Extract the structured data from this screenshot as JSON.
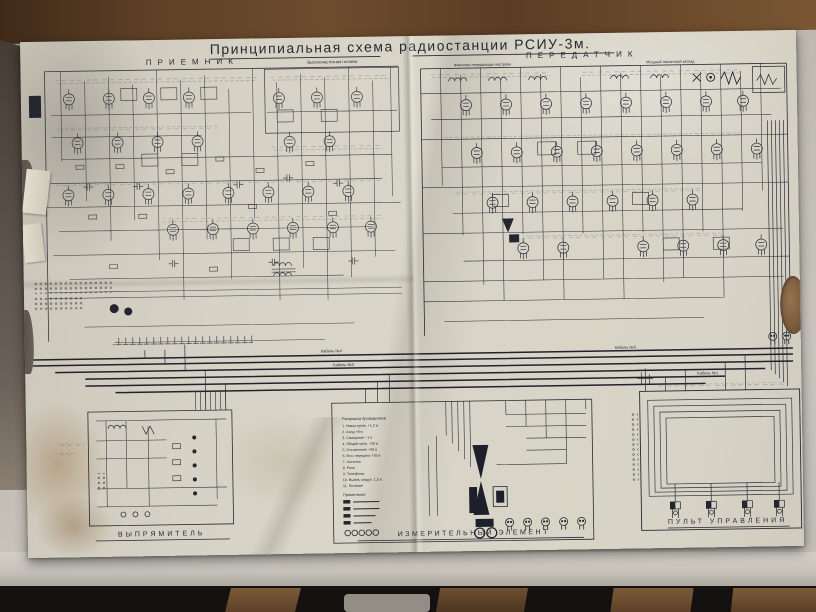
{
  "photo": {
    "description": "aged folded schematic sheet photographed on a wooden table with light backing",
    "colors": {
      "paper": "#d6d2c5",
      "ink": "#262a35",
      "wood": "#5d4026",
      "backing": "#bdb9b1",
      "floor": "#141110"
    }
  },
  "sheet": {
    "title": "Принципиальная схема радиостанции РСИУ-3м.",
    "sections": {
      "receiver": {
        "label": "ПРИЕМНИК",
        "sublabel": "Высокочастотная головка"
      },
      "transmitter": {
        "label": "ПЕРЕДАТЧИК",
        "sublabel_left": "Фиксатор передающих настроек",
        "sublabel_right": "Мощный оконечный каскад"
      },
      "rectifier": {
        "label": "ВЫПРЯМИТЕЛЬ"
      },
      "measuring": {
        "label": "ИЗМЕРИТЕЛЬНЫЙ ЭЛЕМЕНТ"
      },
      "control": {
        "label": "ПУЛЬТ УПРАВЛЕНИЯ"
      }
    },
    "cables": {
      "c1": "Кабель №1",
      "c2": "Кабель №2",
      "c3": "Кабель №3",
      "c4": "Кабель №4"
    },
    "legend": {
      "title": "Раскраска проводников",
      "items": [
        "1. Накал прям.  +1,2 в",
        "2. Анод            +8 в",
        "3. Смещение     −1 в",
        "4. Общий пров. +26 в",
        "5. Отключение +26 в",
        "6. Всп. передача +26 в",
        "7. Антенна",
        "8. Реле",
        "9. Телефоны",
        "10. Вызов, модул. 1,5 в",
        "11. Питание"
      ],
      "note_title": "Примечание:"
    }
  }
}
